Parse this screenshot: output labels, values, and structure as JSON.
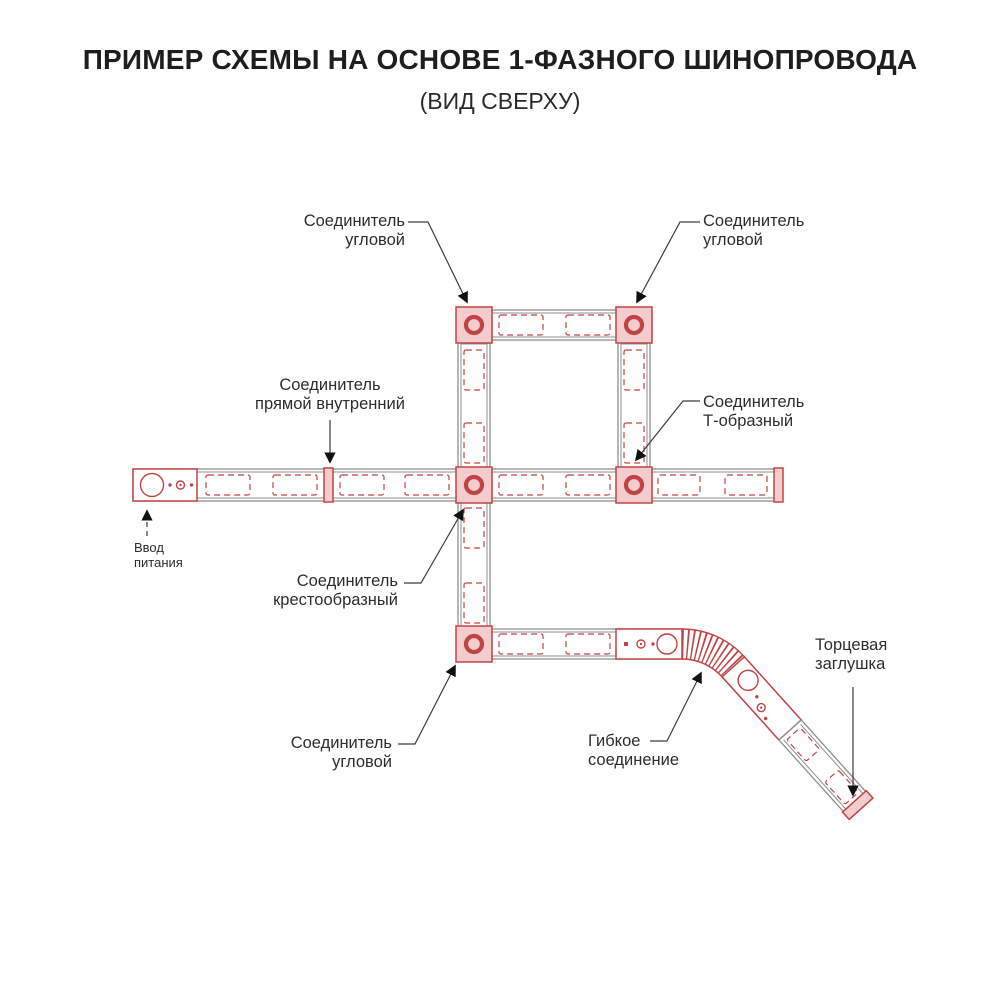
{
  "title": "ПРИМЕР СХЕМЫ НА ОСНОВЕ 1-ФАЗНОГО ШИНОПРОВОДА",
  "subtitle": "(ВИД СВЕРХУ)",
  "labels": {
    "corner_top_left": {
      "line1": "Соединитель",
      "line2": "угловой"
    },
    "corner_top_right": {
      "line1": "Соединитель",
      "line2": "угловой"
    },
    "straight_internal": {
      "line1": "Соединитель",
      "line2": "прямой внутренний"
    },
    "t_shaped": {
      "line1": "Соединитель",
      "line2": "Т-образный"
    },
    "power_input": {
      "line1": "Ввод",
      "line2": "питания"
    },
    "cross_shaped": {
      "line1": "Соединитель",
      "line2": "крестообразный"
    },
    "corner_bottom": {
      "line1": "Соединитель",
      "line2": "угловой"
    },
    "flexible": {
      "line1": "Гибкое",
      "line2": "соединение"
    },
    "end_cap": {
      "line1": "Торцевая",
      "line2": "заглушка"
    }
  },
  "colors": {
    "accent_red": "#c14444",
    "connector_fill": "#f3cdcd",
    "track_gray": "#8f8f8f",
    "text": "#222222",
    "leader": "#3c3c3c"
  }
}
